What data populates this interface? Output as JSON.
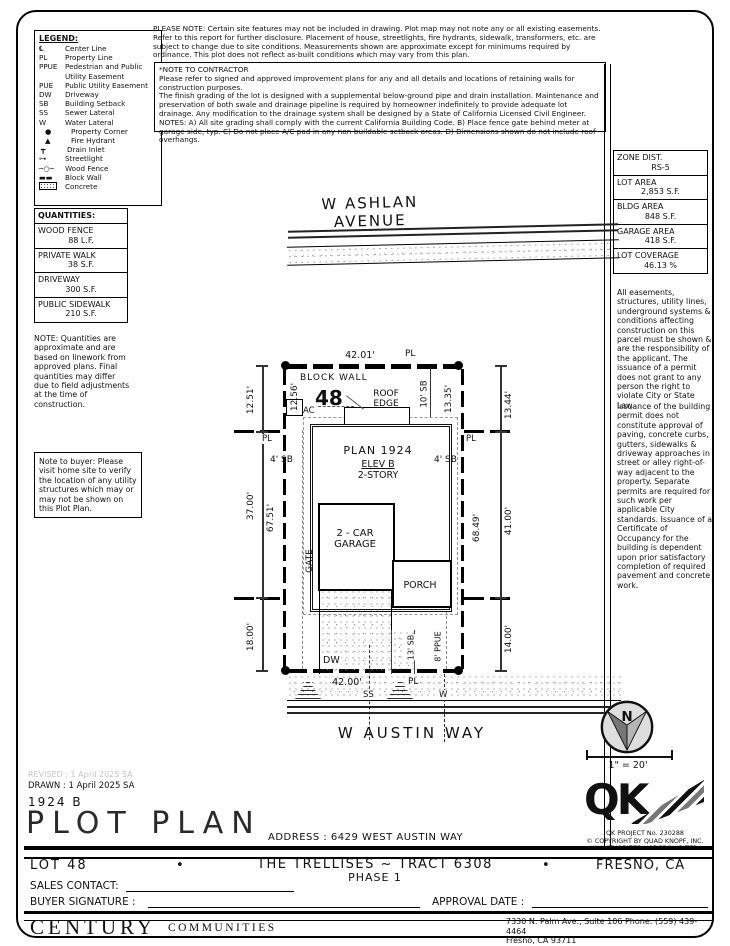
{
  "header": {
    "please_note": "PLEASE NOTE:  Certain site features may not be included in drawing.  Plot map may not note any or all existing easements. Refer to this report for further disclosure.  Placement of house, streetlights, fire hydrants, sidewalk, transformers, etc. are subject to change due to site conditions.  Measurements shown are approximate except for minimums required by ordinance.  This plot does not reflect as-built conditions which may vary from this plan.",
    "contractor": {
      "title": "*NOTE TO CONTRACTOR",
      "p1": "Please refer to signed and approved improvement plans for any and all details and locations of retaining walls for construction purposes.",
      "p2": "The finish grading of the lot is designed with a supplemental below-ground pipe and drain installation.  Maintenance and preservation of both swale and drainage pipeline is required by homeowner indefinitely to provide adequate lot drainage.  Any modification to the drainage system shall be designed by a State of California Licensed Civil Engineer.",
      "p3": "NOTES:  A) All site grading shall comply with the current California Building Code.  B) Place fence gate behind meter at garage side, typ.  C) Do not place A/C pad in any non-buildable setback areas.  D) Dimensions shown do not include roof overhangs."
    }
  },
  "legend": {
    "title": "LEGEND:",
    "items": [
      {
        "symbol": "℄",
        "label": "Center Line"
      },
      {
        "symbol": "PL",
        "label": "Property Line"
      },
      {
        "symbol": "PPUE",
        "label": "Pedestrian and Public Utility Easement"
      },
      {
        "symbol": "PUE",
        "label": "Public Utility Easement"
      },
      {
        "symbol": "DW",
        "label": "Driveway"
      },
      {
        "symbol": "SB",
        "label": "Building Setback"
      },
      {
        "symbol": "SS",
        "label": "Sewer Lateral"
      },
      {
        "symbol": "W",
        "label": "Water Lateral"
      },
      {
        "symbol": "●",
        "label": "Property Corner"
      },
      {
        "symbol": "▲",
        "label": "Fire Hydrant"
      },
      {
        "symbol": "┳",
        "label": "Drain Inlet"
      },
      {
        "symbol": "⊶",
        "label": "Streetlight"
      },
      {
        "symbol": "─○─",
        "label": "Wood Fence"
      },
      {
        "symbol": "▬▬",
        "label": "Block Wall"
      },
      {
        "symbol": "",
        "label": "Concrete"
      }
    ]
  },
  "quantities": {
    "title": "QUANTITIES:",
    "rows": [
      {
        "name": "WOOD FENCE",
        "value": "88 L.F."
      },
      {
        "name": "PRIVATE WALK",
        "value": "38 S.F."
      },
      {
        "name": "DRIVEWAY",
        "value": "300 S.F."
      },
      {
        "name": "PUBLIC SIDEWALK",
        "value": "210 S.F."
      }
    ],
    "note": "NOTE: Quantities are approximate and are based on linework from approved plans.  Final quantities may differ due to field adjustments at the time of construction."
  },
  "buyer_note": "Note to buyer: Please visit home site to verify the location of any utility structures which may or may not be shown on this Plot Plan.",
  "zoning": {
    "rows": [
      {
        "label": "ZONE DIST.",
        "value": "RS-5"
      },
      {
        "label": "LOT AREA",
        "value": "2,853 S.F."
      },
      {
        "label": "BLDG AREA",
        "value": "848 S.F."
      },
      {
        "label": "GARAGE AREA",
        "value": "418 S.F."
      },
      {
        "label": "LOT COVERAGE",
        "value": "46.13 %"
      }
    ]
  },
  "right_notes": {
    "p1": "All easements, structures, utility lines, underground systems & conditions affecting construction on this parcel must be shown & are the responsibility of the applicant. The issuance of a permit does not grant to any person the right to violate City or State Law.",
    "p2": "Issuance of the building permit does not constitute approval of paving, concrete curbs, gutters, sidewalks & driveway approaches in street or alley right-of-way adjacent to the property. Separate permits are required for such work per applicable City standards. Issuance of a Certificate of Occupancy for the building is dependent upon prior satisfactory completion of required pavement and concrete work."
  },
  "plot": {
    "street_top": "W ASHLAN AVENUE",
    "street_bottom": "W AUSTIN WAY",
    "lot_number": "48",
    "block_wall": "BLOCK WALL",
    "roof_edge": "ROOF\nEDGE",
    "ac": "AC",
    "plan": "PLAN 1924",
    "elev": "ELEV B",
    "story": "2-STORY",
    "garage": "2 - CAR\nGARAGE",
    "porch": "PORCH",
    "gate": "GATE",
    "dw": "DW",
    "ss": "SS",
    "w": "W",
    "pl": "PL",
    "dims": {
      "t42": "42.01'",
      "b42": "42.00'",
      "l1": "12.51'",
      "l2": "37.00'",
      "l3": "18.00'",
      "li1": "12.56'",
      "li2": "67.51'",
      "r1": "13.44'",
      "r2": "41.00'",
      "r3": "14.00'",
      "ri1": "13.35'",
      "ri2": "68.49'",
      "sb10": "10' SB",
      "sb4": "4' SB",
      "sb13": "13' SB",
      "ppue8": "8' PPUE"
    }
  },
  "compass": {
    "n": "N",
    "scale": "1\" = 20'"
  },
  "qk": {
    "logo": "QK",
    "line1": "QK PROJECT No. 230288",
    "line2": "© COPYRIGHT BY QUAD KNOPF, INC.",
    "line3": "UNAUTHORIZED USE PROHIBITED."
  },
  "titleblock": {
    "revised": "REVISED :  1 April 2025  SA",
    "drawn": "DRAWN :  1 April 2025  SA",
    "plan_code": "1924  B",
    "title": "PLOT PLAN",
    "address": "ADDRESS :  6429 WEST AUSTIN WAY",
    "lot": "LOT 48",
    "tract": "THE TRELLISES ~ TRACT 6308",
    "phase": "PHASE 1",
    "city": "FRESNO, CA",
    "bullet": "•",
    "sales_contact": "SALES CONTACT:",
    "buyer_signature": "BUYER SIGNATURE :",
    "approval_date": "APPROVAL DATE :"
  },
  "footer": {
    "brand": "CENTURY",
    "brand_sub": "COMMUNITIES",
    "addr1": "7330 N. Palm Ave., Suite 106    Phone:  (559) 439-4464",
    "addr2": "Fresno, CA  93711"
  }
}
